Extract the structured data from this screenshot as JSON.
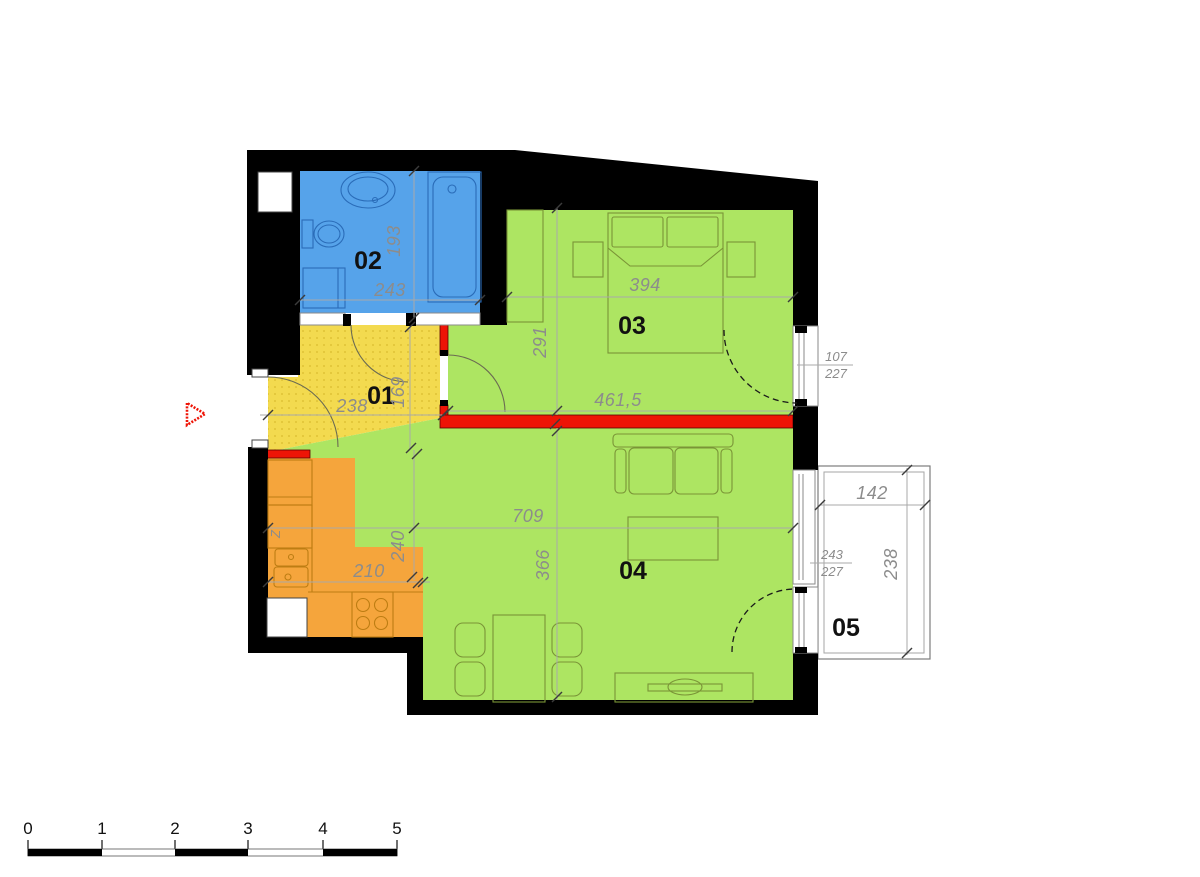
{
  "title": "apartment-floor-plan",
  "rooms": {
    "r01": {
      "label": "01",
      "color": "#F3DA4F",
      "width": "238",
      "height": "169"
    },
    "r02": {
      "label": "02",
      "color": "#56A3EA",
      "width": "243",
      "height": "193"
    },
    "r03": {
      "label": "03",
      "color": "#ADE562",
      "width": "394",
      "height": "291",
      "width_lower": "461,5",
      "balcony_door_width": "107",
      "balcony_door_height": "227"
    },
    "r04": {
      "label": "04",
      "color": "#ADE562",
      "width": "709",
      "height": "366"
    },
    "r05": {
      "label": "05",
      "color": "#FFFFFF",
      "width": "142",
      "height": "238",
      "window_width": "243",
      "window_height": "227"
    },
    "kitchen": {
      "color": "#F5A53C",
      "width": "210",
      "height": "240",
      "appliance_label": "Z"
    }
  },
  "colors": {
    "structural_wall": "#000000",
    "new_partition": "#EE1406",
    "entrance_marker": "#EE1406",
    "dimension_text": "#8C8C8C"
  },
  "scale_bar": {
    "labels": [
      "0",
      "1",
      "2",
      "3",
      "4",
      "5"
    ]
  }
}
